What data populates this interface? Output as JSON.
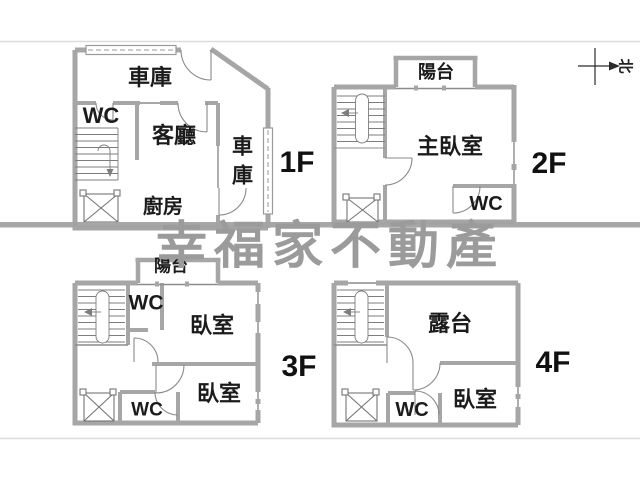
{
  "watermark": {
    "text": "幸福家不動產",
    "color": "#9b9b9b"
  },
  "compass": {
    "north": "北"
  },
  "floor1": {
    "name": "1F",
    "garage_top": "車庫",
    "wc": "WC",
    "living_room": "客廳",
    "garage_side": "車庫",
    "kitchen": "廚房"
  },
  "floor2": {
    "name": "2F",
    "balcony": "陽台",
    "master_bedroom": "主臥室",
    "wc": "WC"
  },
  "floor3": {
    "name": "3F",
    "balcony": "陽台",
    "wc_upper": "WC",
    "bedroom_upper": "臥室",
    "bedroom_lower": "臥室",
    "wc_lower": "WC"
  },
  "floor4": {
    "name": "4F",
    "terrace": "露台",
    "bedroom": "臥室",
    "wc": "WC"
  },
  "colors": {
    "wall": "#a6a6a6",
    "thin_line": "#8c8c8c",
    "detail_line": "#7d7d7d",
    "text": "#1b1b1b",
    "frame_line": "#dcdcdc"
  }
}
